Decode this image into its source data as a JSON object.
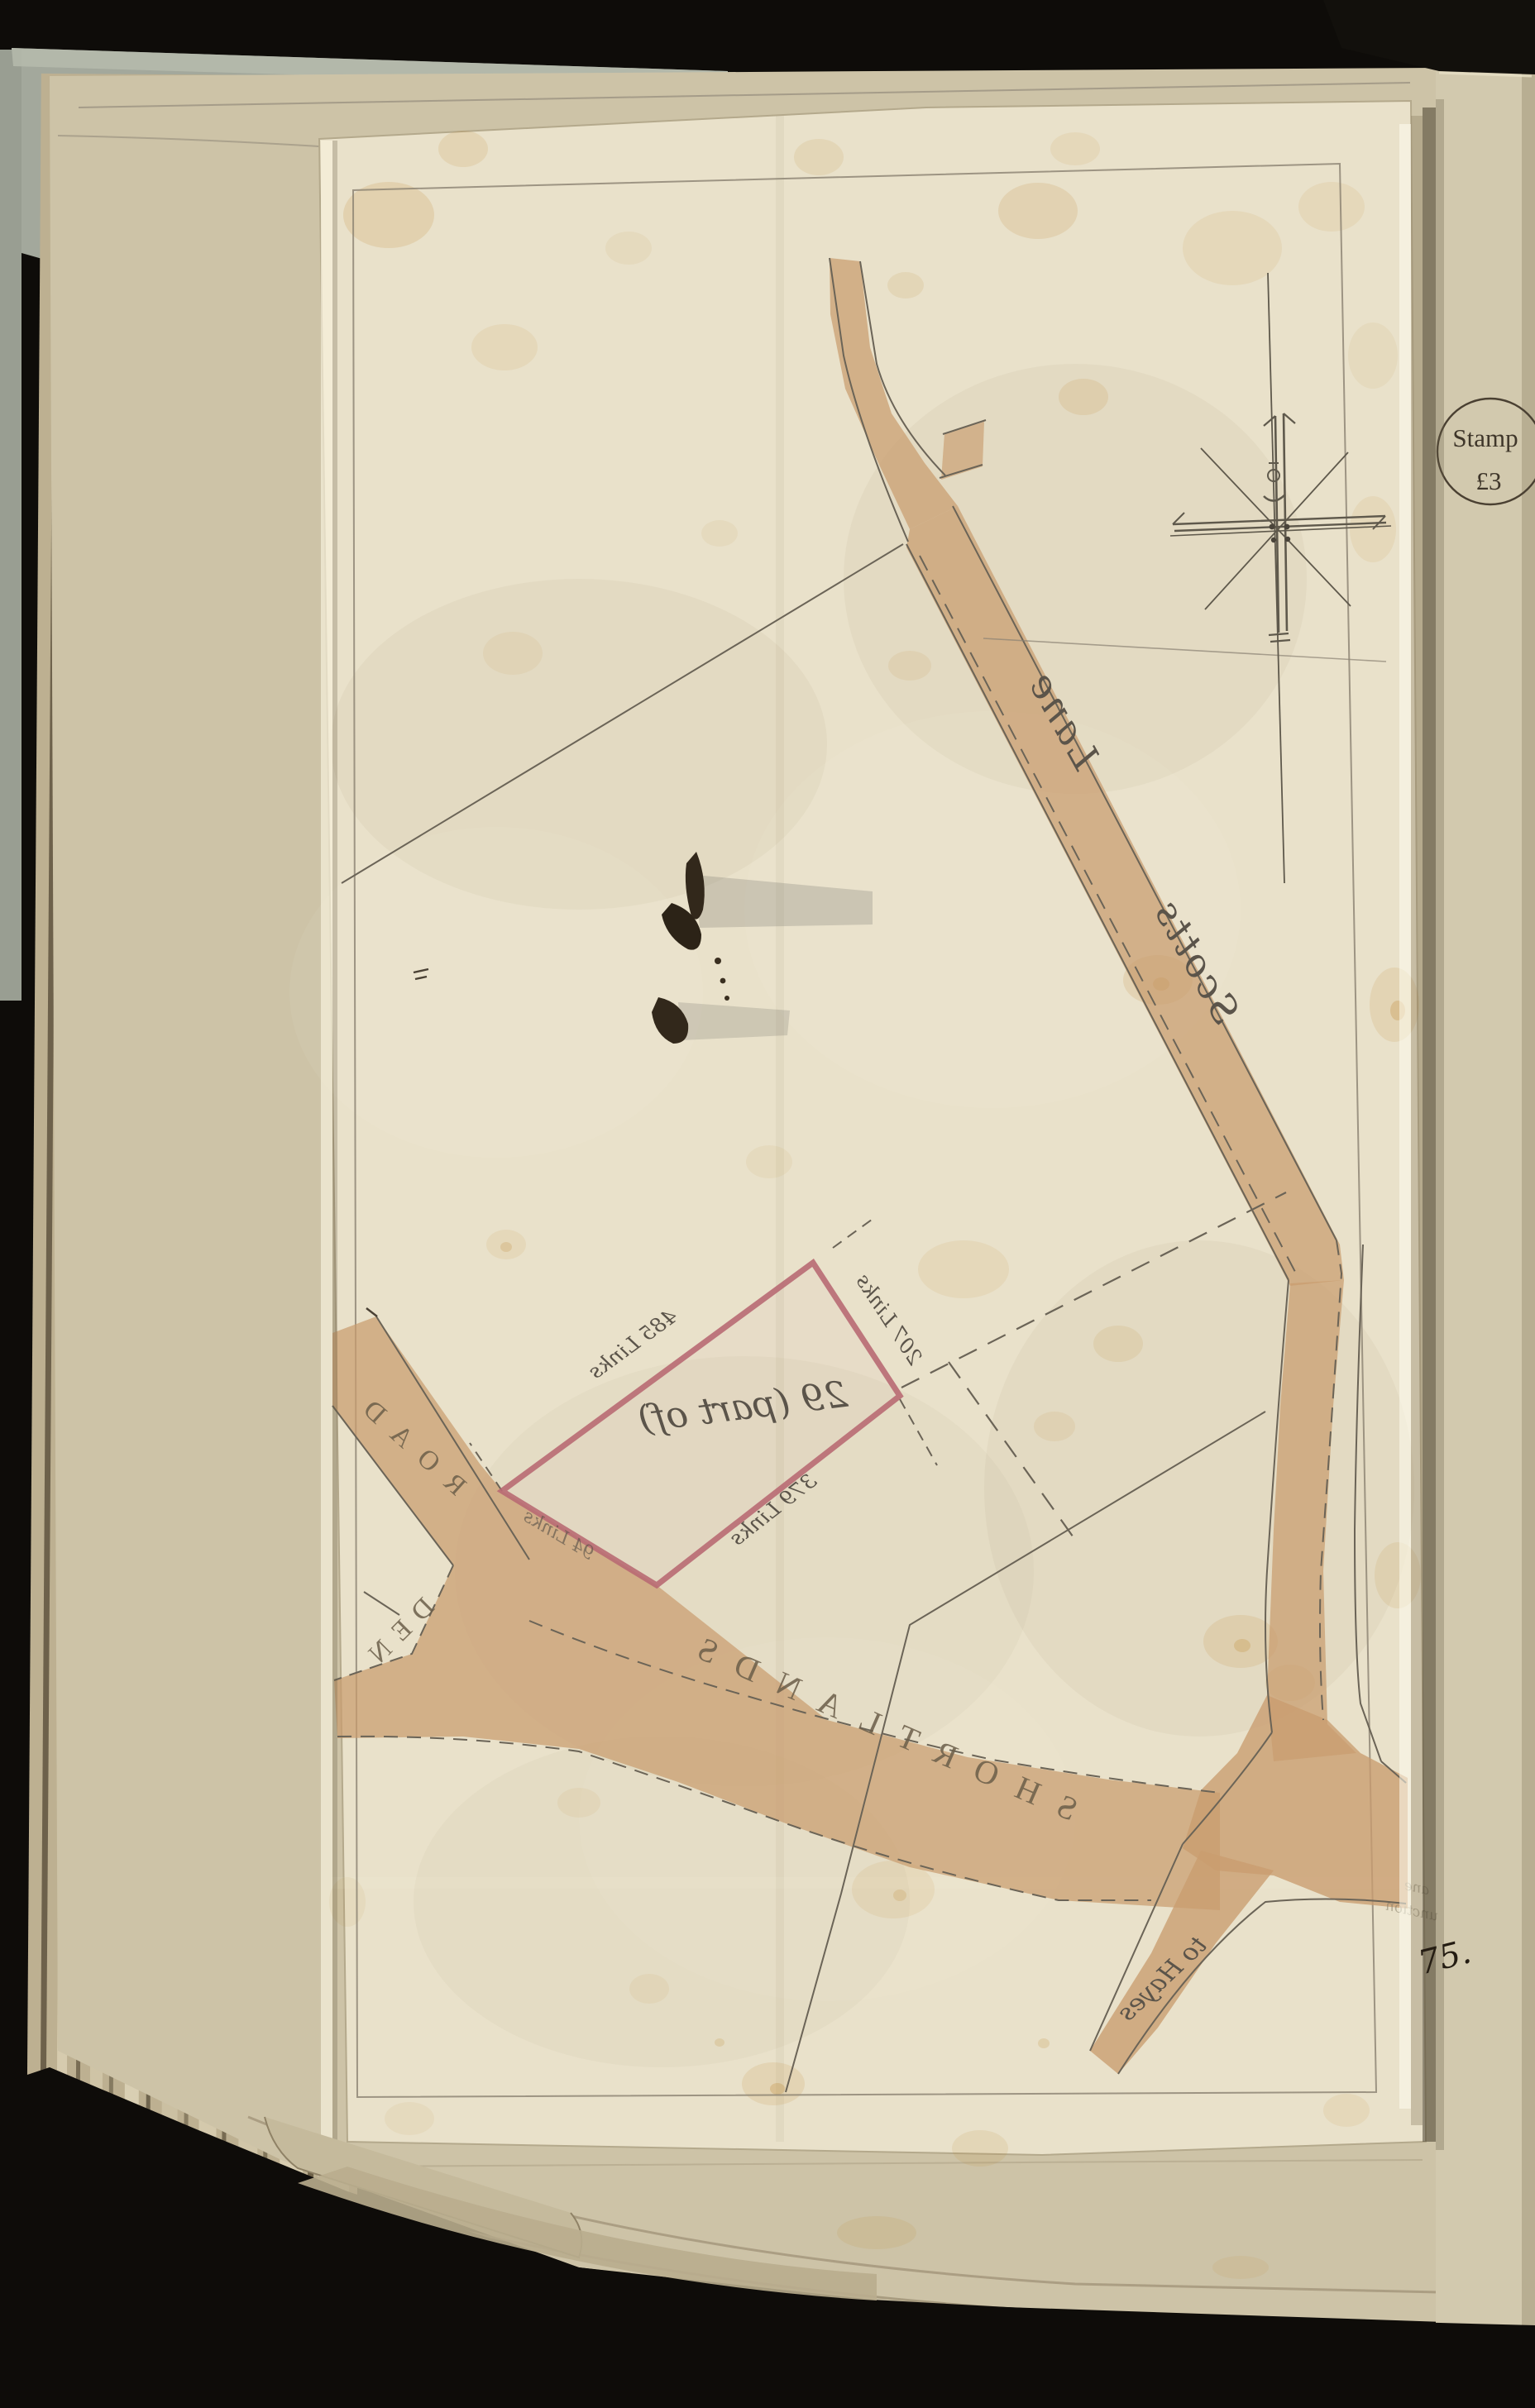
{
  "map": {
    "plot_label": "29 (part of)",
    "road_names": {
      "scotts": "Scotts",
      "lane": "Lane",
      "shortlands": "SHORTLANDS",
      "den": "DEN",
      "road": "ROAD",
      "to_hayes": "to Hayes"
    },
    "measurements": {
      "nw_edge": "485 Links",
      "ne_edge": "207 Links",
      "se_edge": "379 Links",
      "sw_edge": "94 Links"
    },
    "edge_fragment": {
      "line1": "ane",
      "line2": "unction"
    }
  },
  "stamp": {
    "line1": "Stamp",
    "line2": "£3"
  },
  "page_number": "75.",
  "colors": {
    "background": "#0e0c09",
    "tracing_sheet": "#e9e1ca",
    "album_page": "#d2c9ae",
    "under_page": "#cdc3a7",
    "road_fill": "#c99c6f",
    "plot_outline": "#b96b74",
    "pencil": "#6b6457",
    "ink_text": "#57514a",
    "stain": "#c08a35"
  }
}
